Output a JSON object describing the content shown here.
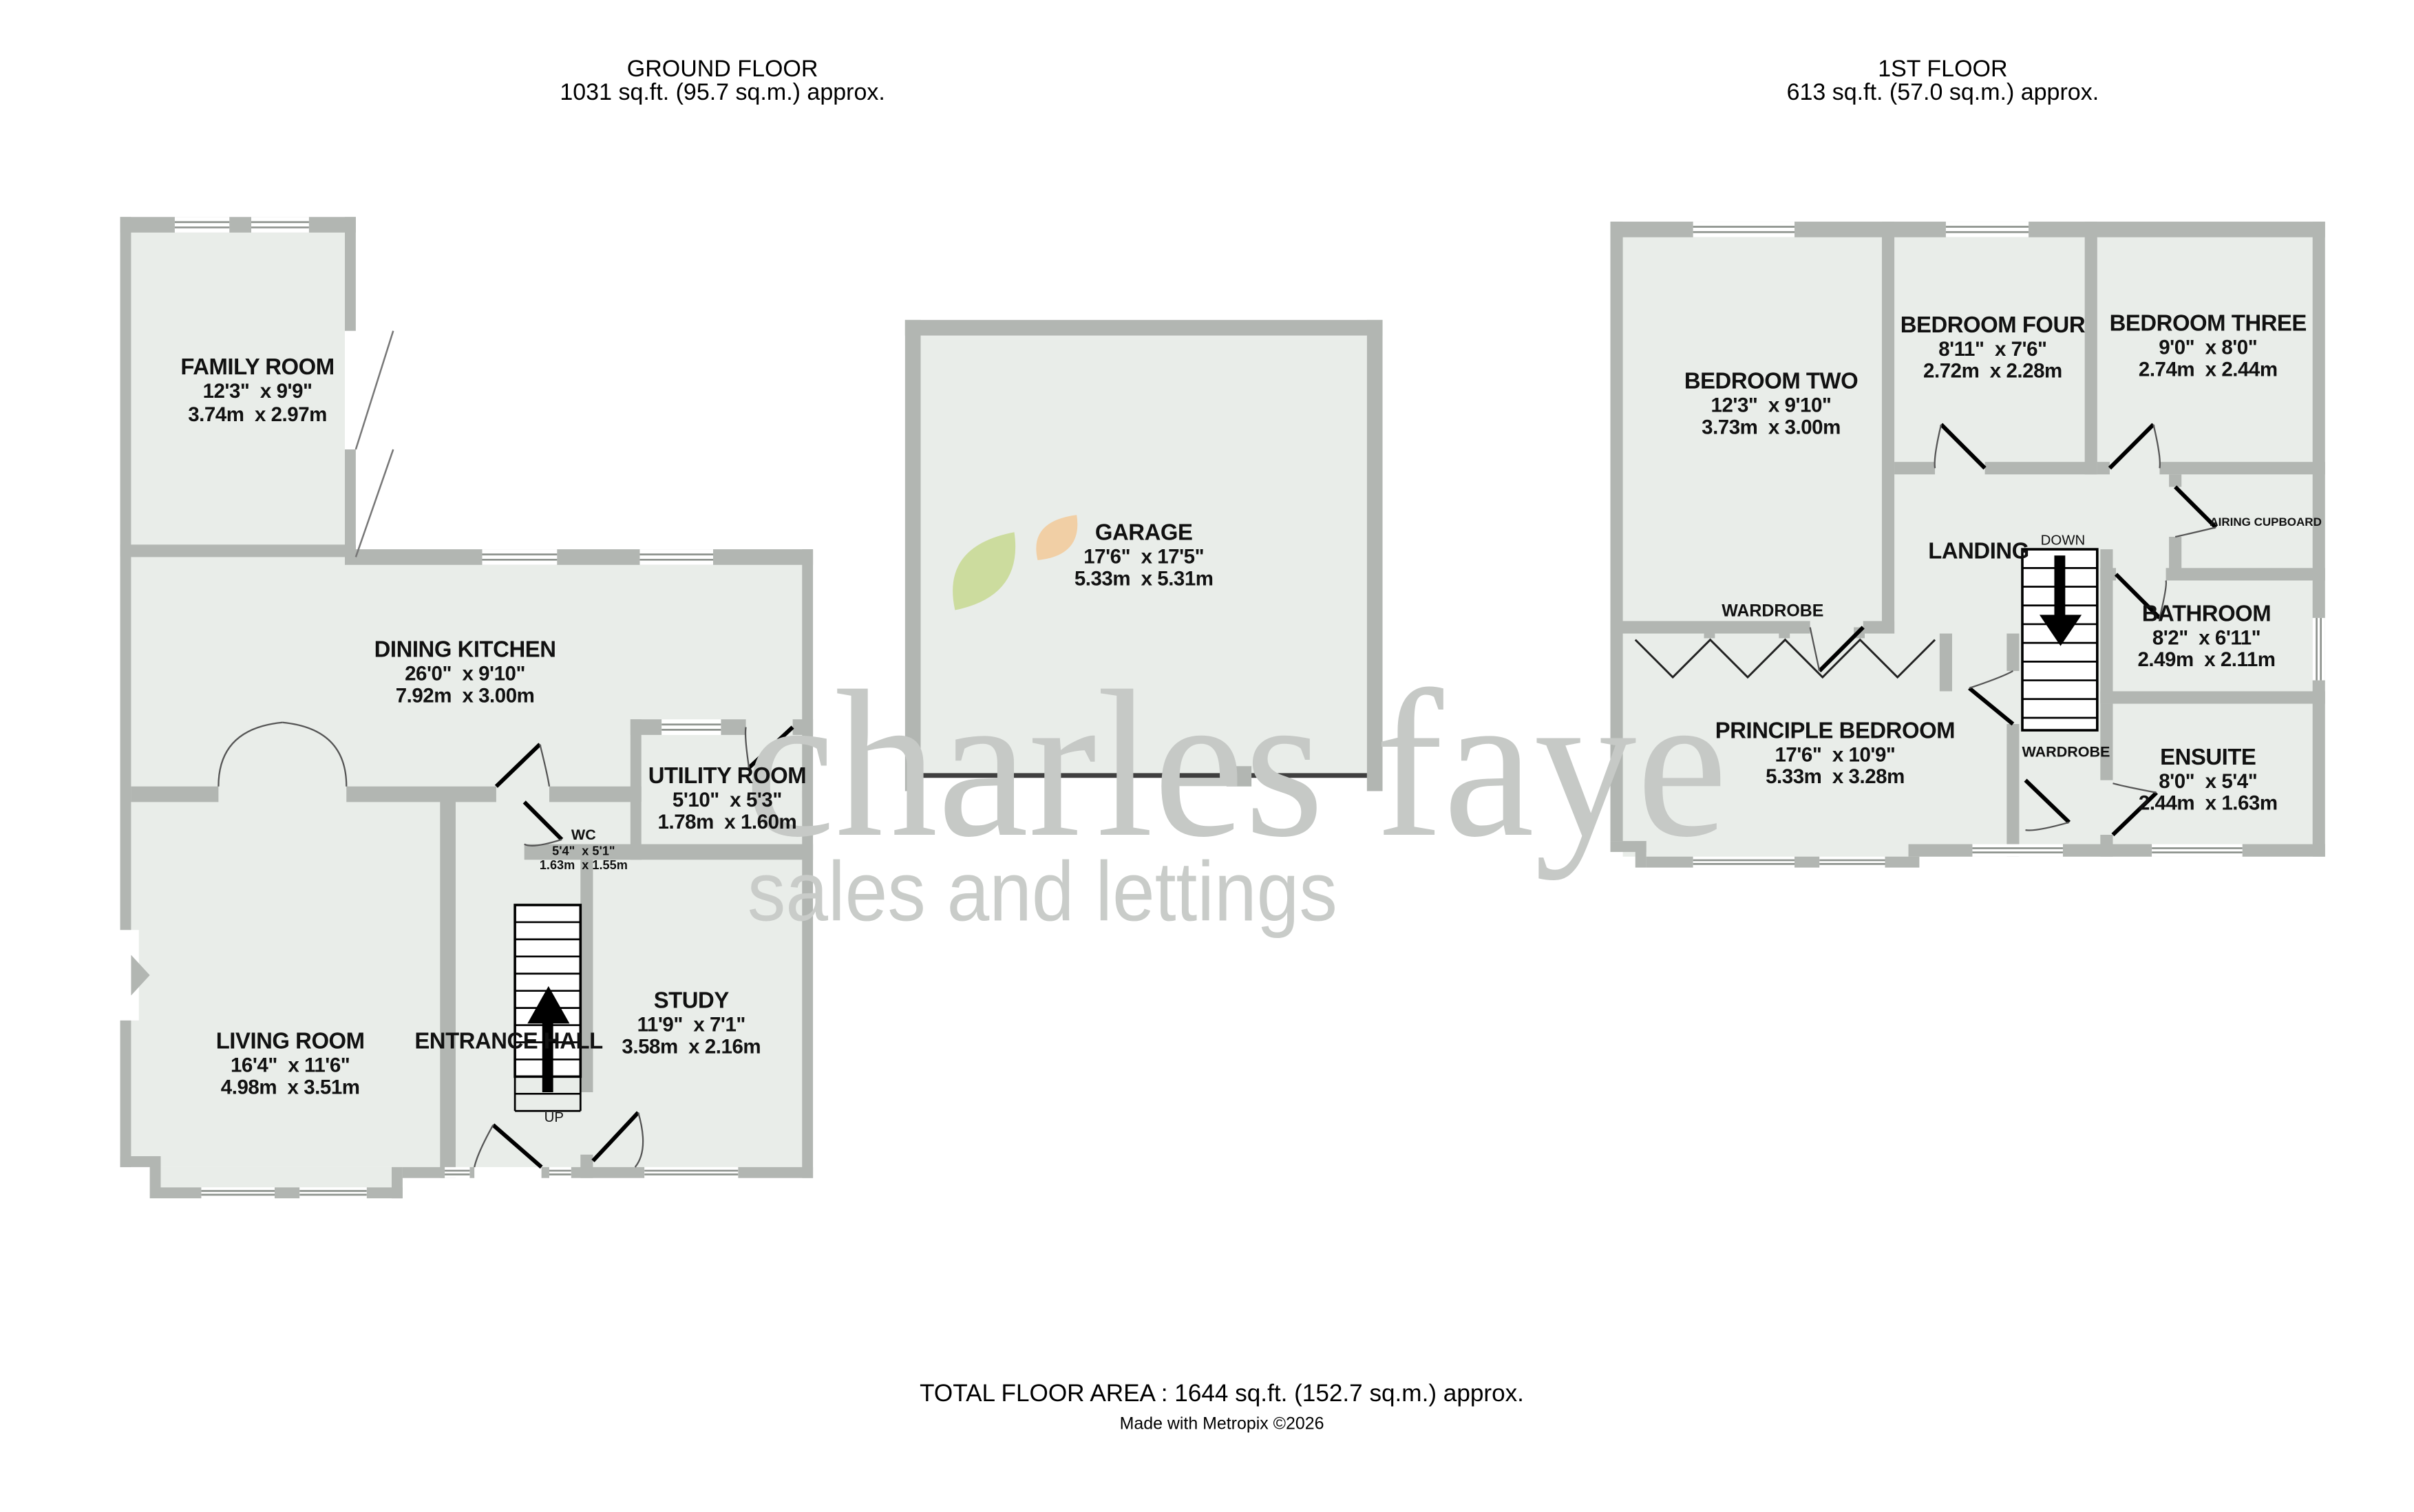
{
  "colors": {
    "wall": "#b2b6b2",
    "floor": "#e9ede9",
    "watermark_gray": "#c6c9c6",
    "leaf_green": "#ccdc9e",
    "leaf_orange": "#f1cfa5",
    "door_leaf": "#000000",
    "garage_door": "#3f3f3f"
  },
  "header": {
    "ground_floor": {
      "title": "GROUND FLOOR",
      "area": "1031 sq.ft. (95.7 sq.m.) approx."
    },
    "first_floor": {
      "title": "1ST FLOOR",
      "area": "613 sq.ft. (57.0 sq.m.) approx."
    }
  },
  "watermark": {
    "brand": "charles faye",
    "tagline": "sales and lettings"
  },
  "ground_floor": {
    "stair_label": "UP",
    "rooms": [
      {
        "name": "FAMILY ROOM",
        "imperial": "12'3\"  x 9'9\"",
        "metric": "3.74m  x 2.97m"
      },
      {
        "name": "DINING KITCHEN",
        "imperial": "26'0\"  x 9'10\"",
        "metric": "7.92m  x 3.00m"
      },
      {
        "name": "UTILITY ROOM",
        "imperial": "5'10\"  x 5'3\"",
        "metric": "1.78m  x 1.60m"
      },
      {
        "name": "WC",
        "imperial": "5'4\"  x 5'1\"",
        "metric": "1.63m  x 1.55m"
      },
      {
        "name": "LIVING ROOM",
        "imperial": "16'4\"  x 11'6\"",
        "metric": "4.98m  x 3.51m"
      },
      {
        "name": "ENTRANCE HALL"
      },
      {
        "name": "STUDY",
        "imperial": "11'9\"  x 7'1\"",
        "metric": "3.58m  x 2.16m"
      }
    ]
  },
  "garage": {
    "name": "GARAGE",
    "imperial": "17'6\"  x 17'5\"",
    "metric": "5.33m  x 5.31m"
  },
  "first_floor": {
    "stair_label": "DOWN",
    "rooms": [
      {
        "name": "BEDROOM TWO",
        "imperial": "12'3\"  x 9'10\"",
        "metric": "3.73m  x 3.00m"
      },
      {
        "name": "BEDROOM FOUR",
        "imperial": "8'11\"  x 7'6\"",
        "metric": "2.72m  x 2.28m"
      },
      {
        "name": "BEDROOM THREE",
        "imperial": "9'0\"  x 8'0\"",
        "metric": "2.74m  x 2.44m"
      },
      {
        "name": "LANDING"
      },
      {
        "name": "WARDROBE"
      },
      {
        "name": "PRINCIPLE BEDROOM",
        "imperial": "17'6\"  x 10'9\"",
        "metric": "5.33m  x 3.28m"
      },
      {
        "name": "BATHROOM",
        "imperial": "8'2\"  x 6'11\"",
        "metric": "2.49m  x 2.11m"
      },
      {
        "name": "ENSUITE",
        "imperial": "8'0\"  x 5'4\"",
        "metric": "2.44m  x 1.63m"
      },
      {
        "name": "AIRING CUPBOARD"
      },
      {
        "name": "WARDROBE"
      }
    ]
  },
  "footer": {
    "total": "TOTAL FLOOR AREA : 1644 sq.ft. (152.7 sq.m.) approx.",
    "credit": "Made with Metropix ©2026"
  }
}
